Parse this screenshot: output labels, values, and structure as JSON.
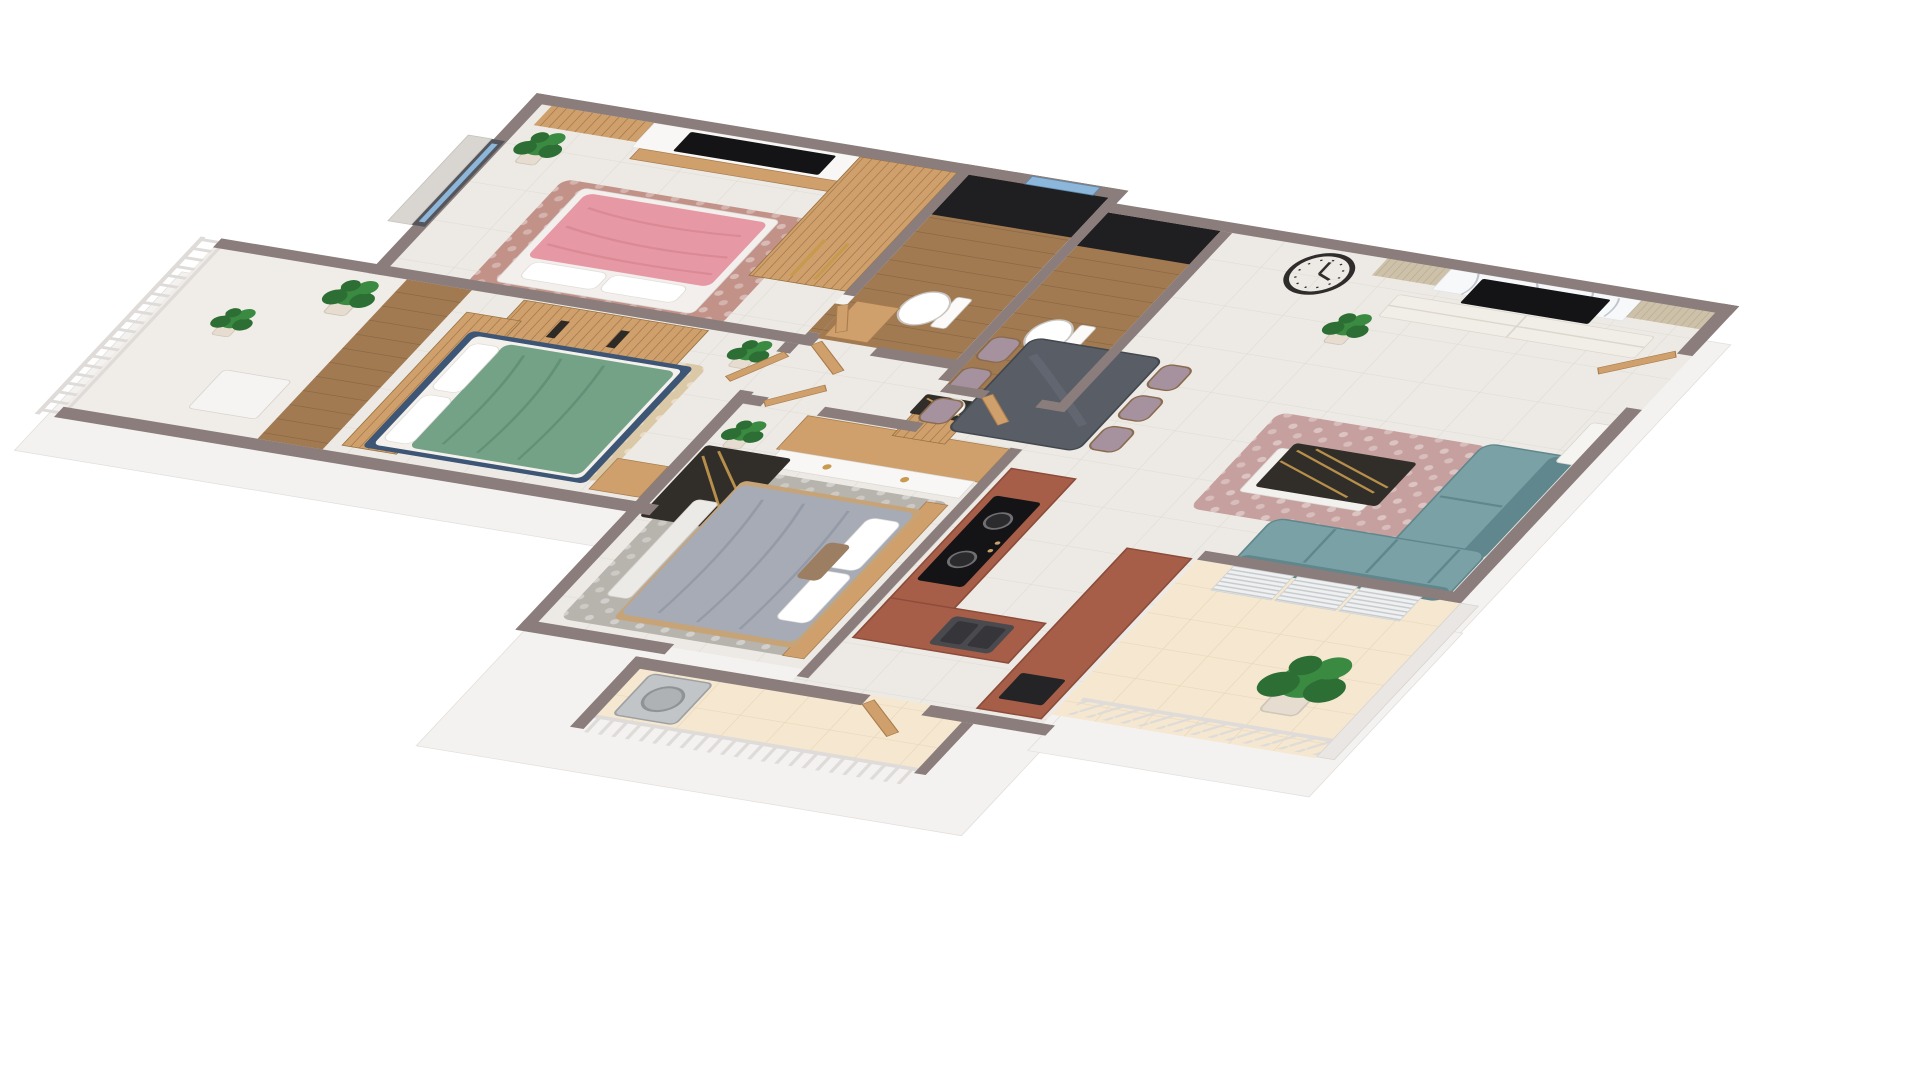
{
  "scene": {
    "type": "3d-isometric-floor-plan-render",
    "background": "#ffffff",
    "description": "Top-down 3D render of a 3-bedroom apartment with open living-dining-kitchen and three balconies"
  },
  "palette": {
    "wall": "#8a7d7b",
    "parapet": "#e9e6e3",
    "offWhite": "#f4f2f0",
    "extrudeEdge": "#e2dedb",
    "floor": "#edeae5",
    "floorLine": "#dfdbd4",
    "woodFloor": "#a27a52",
    "woodFloorDark": "#8a6743",
    "wood": "#cfa06b",
    "woodDark": "#a87c4e",
    "woodLight": "#e0bd8d",
    "slatBeige": "#cdc1a9",
    "slatBeigeDark": "#b6a98d",
    "cream": "#f5e7d0",
    "creamLine": "#e8d6b8",
    "panelWhite": "#f8f7f5",
    "tvBlack": "#141416",
    "marbleDark": "#312e2a",
    "goldVein": "#c79a4e",
    "marbleVein": "#b9bfc9",
    "pinkBed": "#e699a4",
    "pinkFold": "#d4818f",
    "greenBed": "#73a287",
    "greenFold": "#5d8a70",
    "blueFrame": "#3d5675",
    "grayBed": "#a6abb6",
    "grayFold": "#8e93a1",
    "rug1": "#c29289",
    "rug2": "#dbc8a7",
    "rug3": "#b7b3ad",
    "rugLiving": "#c6a09e",
    "teal": "#7aa1a6",
    "tealDark": "#5f878d",
    "terracotta": "#a65e49",
    "terracottaEdge": "#8c4c3a",
    "steel": "#c2c5c8",
    "steelDark": "#9da1a4",
    "plant": "#3b8a41",
    "plantDark": "#2c6e33",
    "pot": "#e6ddd0",
    "railing": "#dedbd8",
    "blind": "#d9d5d0",
    "glassBlue": "#8cb6da",
    "chairMauve": "#a5929e",
    "diningTable": "#585d66",
    "white": "#ffffff",
    "benchWhite": "#eceae6",
    "clockDark": "#2f2d2b"
  },
  "rooms": [
    {
      "name": "bedroom-1",
      "bed_color_key": "pinkBed",
      "items": [
        "double-bed",
        "wardrobe",
        "wood-slat-panel",
        "tv-panel",
        "wall-tv",
        "wood-shelf",
        "window-blind",
        "rug",
        "plant"
      ]
    },
    {
      "name": "ensuite-bathroom",
      "items": [
        "wood-floor",
        "black-shower-wall",
        "window",
        "toilet",
        "cabinet"
      ]
    },
    {
      "name": "bedroom-2",
      "bed_color_key": "greenBed",
      "items": [
        "double-bed",
        "slat-dresser",
        "slat-wardrobe",
        "nightstand",
        "rug",
        "plant"
      ]
    },
    {
      "name": "west-balcony",
      "items": [
        "baluster-railing",
        "wood-deck",
        "desk",
        "plants"
      ]
    },
    {
      "name": "corridor",
      "items": [
        "door-bedroom-1",
        "door-bedroom-2",
        "door-bedroom-3"
      ]
    },
    {
      "name": "bedroom-3",
      "bed_color_key": "grayBed",
      "items": [
        "double-bed",
        "wardrobe-wood-top",
        "marble-desk",
        "chair",
        "bench",
        "rug",
        "plant"
      ]
    },
    {
      "name": "shared-bathroom",
      "items": [
        "wood-floor",
        "black-shower-wall",
        "toilet",
        "door",
        "laundry-cabinet-marble-top"
      ]
    },
    {
      "name": "kitchen",
      "items": [
        "l-counter-terracotta",
        "cooktop-2-burner",
        "sink",
        "peninsula-counter",
        "oven-front",
        "balcony-door"
      ]
    },
    {
      "name": "living-dining",
      "items": [
        "wall-clock",
        "dining-table",
        "dining-chairs-x6",
        "tv-marble-wall",
        "slat-panels",
        "wall-tv",
        "media-console",
        "sofa-sectional",
        "coffee-table-marble",
        "rug",
        "entry-door",
        "wall-sconce",
        "plants"
      ]
    },
    {
      "name": "south-balcony",
      "items": [
        "lattice-railing",
        "parapet-wall",
        "ac-louver-panels-x3",
        "large-plant"
      ]
    },
    {
      "name": "service-balcony",
      "items": [
        "baluster-railing",
        "washing-machine"
      ]
    }
  ],
  "counts": {
    "bedrooms": 3,
    "bathrooms": 2,
    "balconies": 3,
    "toilets": 2,
    "tvs": 2,
    "plants": 9,
    "dining_chairs": 6
  }
}
